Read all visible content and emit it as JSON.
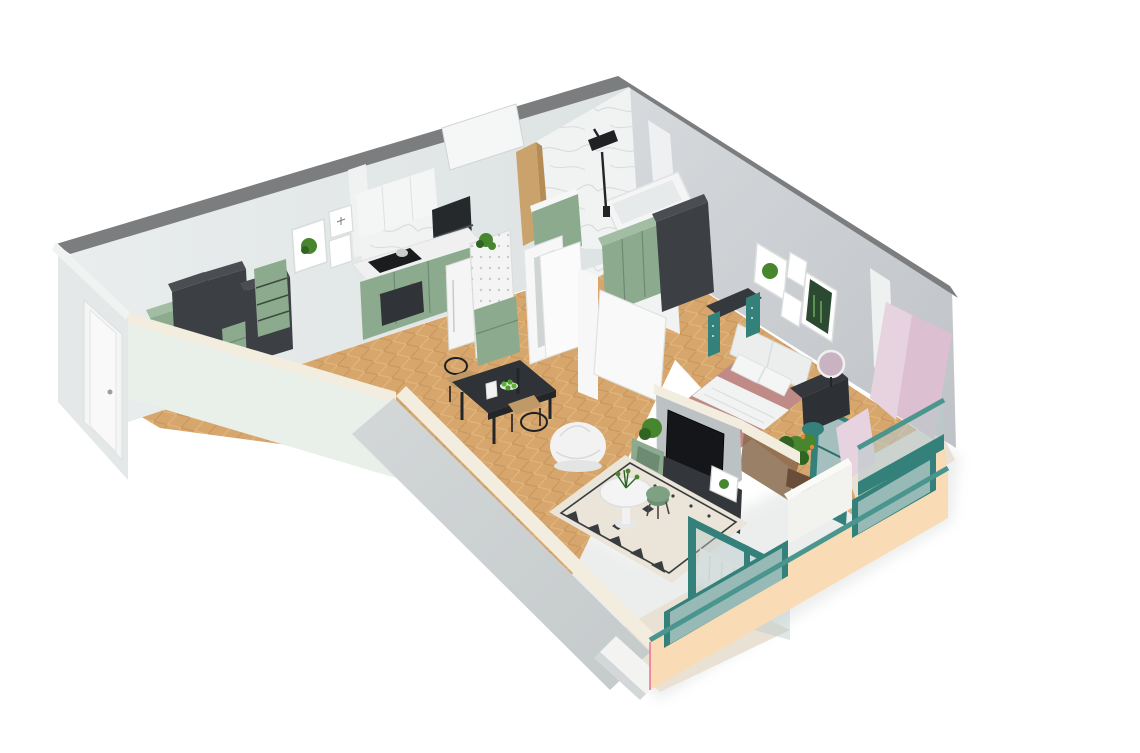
{
  "scene": {
    "type": "isometric-cutaway-apartment-floor-plan",
    "background": "#ffffff"
  },
  "palette": {
    "background": "#ffffff",
    "wallTop": "#7b7d7e",
    "white": "#f4f5f4",
    "cream": "#f2edde",
    "paleFace": "#e9efe9",
    "facade": "#e4e8e8",
    "pinkWall": "#dcbfd0",
    "pinkLight": "#e7d2e0",
    "peach": "#f9dcb5",
    "teal": "#33817a",
    "tealDark": "#266b64",
    "tealLight": "#4a968e",
    "glass": "#b9cac9",
    "sage": "#8cab8e",
    "sageLight": "#a3bda4",
    "sageDark": "#6d8a72",
    "charcoal": "#3c3f44",
    "charcoalTop": "#4a4e53",
    "charcoalDark": "#2b2e32",
    "tv": "#141619",
    "wood": "#d7a66c",
    "woodDark": "#c6955c",
    "woodJamb": "#c9a36b",
    "marble": "#f1f2f2",
    "marbleVein": "#c9cdd2",
    "rose": "#c08b86",
    "roseDark": "#b07a76",
    "rug": "#eae5d8",
    "rugDark": "#3a3d40",
    "plant": "#47862f",
    "plantDark": "#2f6423",
    "orange": "#e8872f",
    "radiator": "#eef0ef",
    "balconyFloor": "#e9e2d4",
    "caneSeat": "#c09a66",
    "magentaEdge": "#ef6c96"
  },
  "rooms": [
    {
      "name": "hallway",
      "furniture": [
        "entry-door",
        "wardrobe-columns",
        "sage-cabinets",
        "open-shelf",
        "wall-art-plant",
        "wall-art-dragonfly"
      ]
    },
    {
      "name": "kitchen",
      "furniture": [
        "sage-base-cabinets",
        "marble-counter",
        "cooktop",
        "oven-column",
        "fridge",
        "pegboard-partition",
        "counter-plant"
      ]
    },
    {
      "name": "dining-area",
      "furniture": [
        "dark-table",
        "cane-chairs",
        "vase",
        "fruit-bowl"
      ]
    },
    {
      "name": "bathroom",
      "furniture": [
        "marble-walls",
        "shower-set",
        "bathtub",
        "sage-vanity",
        "door"
      ]
    },
    {
      "name": "bedroom",
      "furniture": [
        "double-bed-rose-bedding",
        "headboard-cushions",
        "teal-desk",
        "dark-vanity",
        "round-mirror",
        "teal-stool",
        "wardrobe",
        "sage-cabinets",
        "wall-art-frames",
        "balcony-door",
        "plant"
      ]
    },
    {
      "name": "living-room",
      "furniture": [
        "bean-bag",
        "patterned-rug",
        "round-table",
        "sage-stool",
        "tv",
        "media-console",
        "leaning-frame",
        "console-plant"
      ]
    },
    {
      "name": "living-balcony",
      "furniture": [
        "teal-railing",
        "glass-panels",
        "radiator",
        "peach-parapet"
      ]
    },
    {
      "name": "bedroom-balcony",
      "furniture": [
        "teal-railing",
        "glass-panels",
        "pink-walls",
        "peach-parapet"
      ]
    }
  ]
}
